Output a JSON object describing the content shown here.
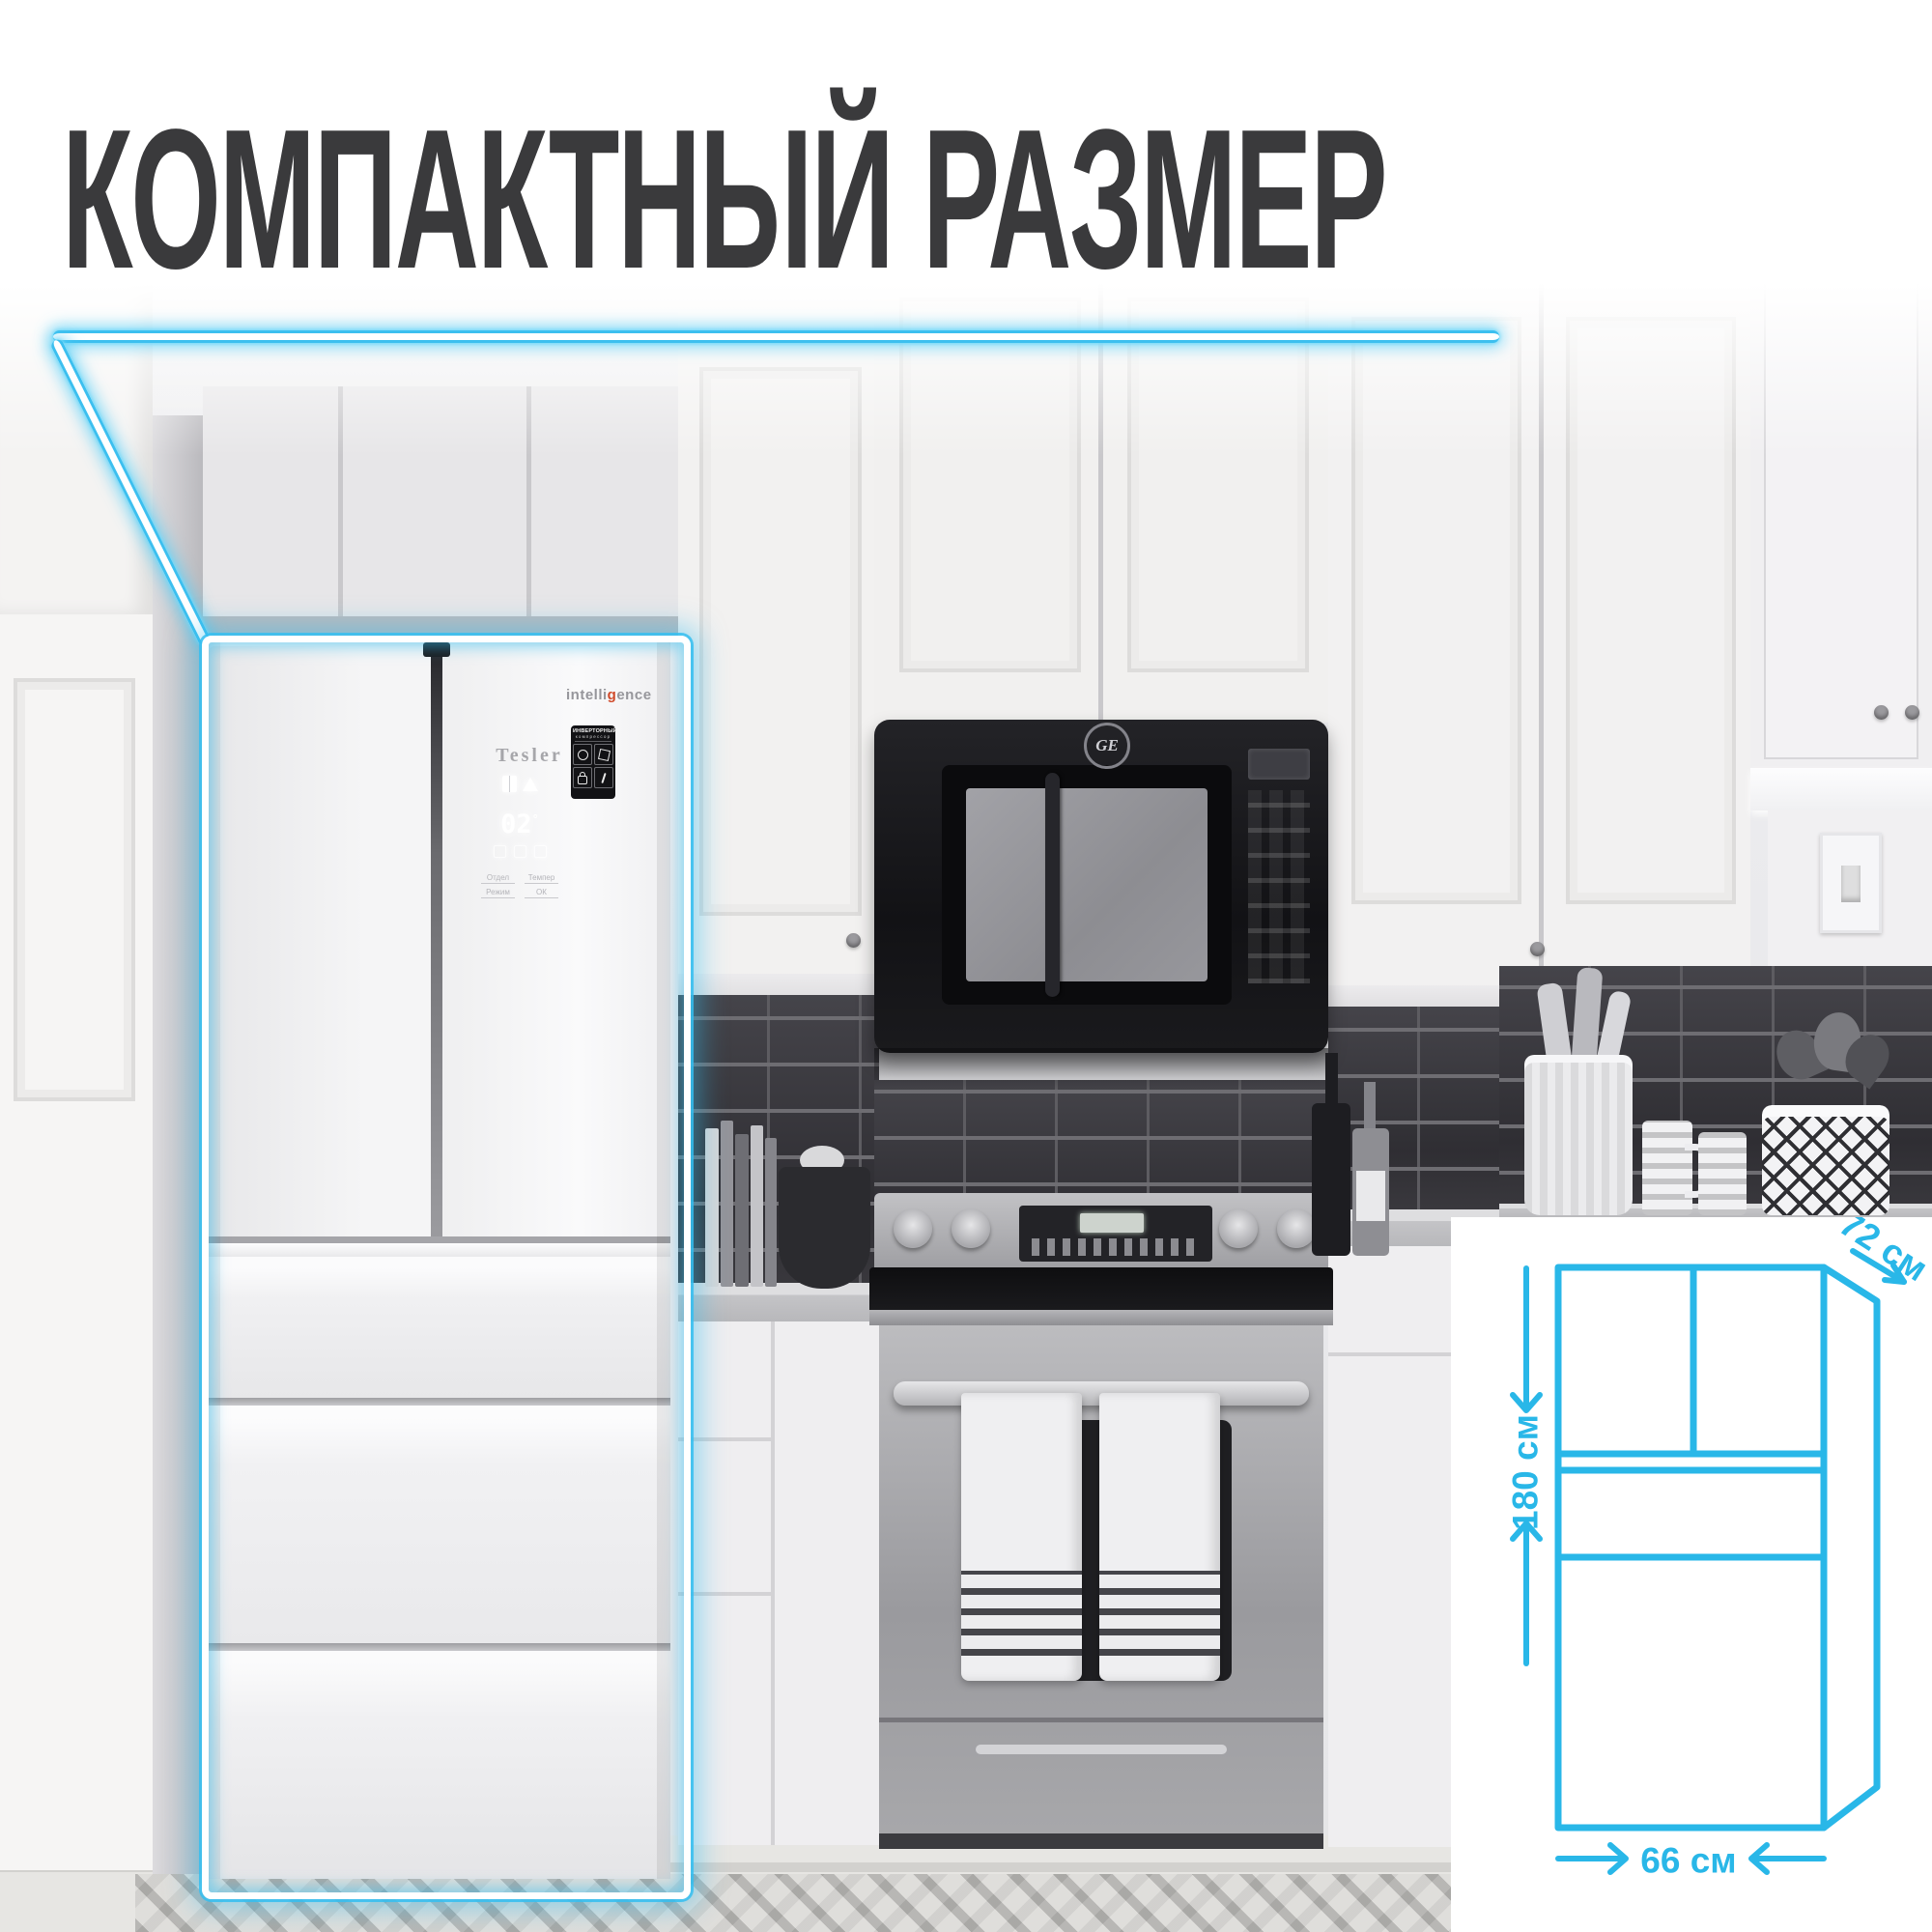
{
  "header": {
    "title": "КОМПАКТНЫЙ РАЗМЕР"
  },
  "accent": {
    "cyan": "#29b7e8",
    "title_color": "#3a3a3c"
  },
  "fridge": {
    "brand": "Tesler",
    "badge_left": "intelli",
    "badge_g": "g",
    "badge_right": "ence",
    "sticker": {
      "title": "ИНВЕРТОРНЫЙ",
      "subtitle": "компрессор"
    },
    "display": {
      "value": "02",
      "degree": "°",
      "labels": [
        "Отдел",
        "Темпер",
        "Режим",
        "ОК"
      ]
    }
  },
  "microwave": {
    "brand": "GE"
  },
  "dimensions": {
    "depth": "72 см",
    "height": "180 см",
    "width": "66 см"
  }
}
